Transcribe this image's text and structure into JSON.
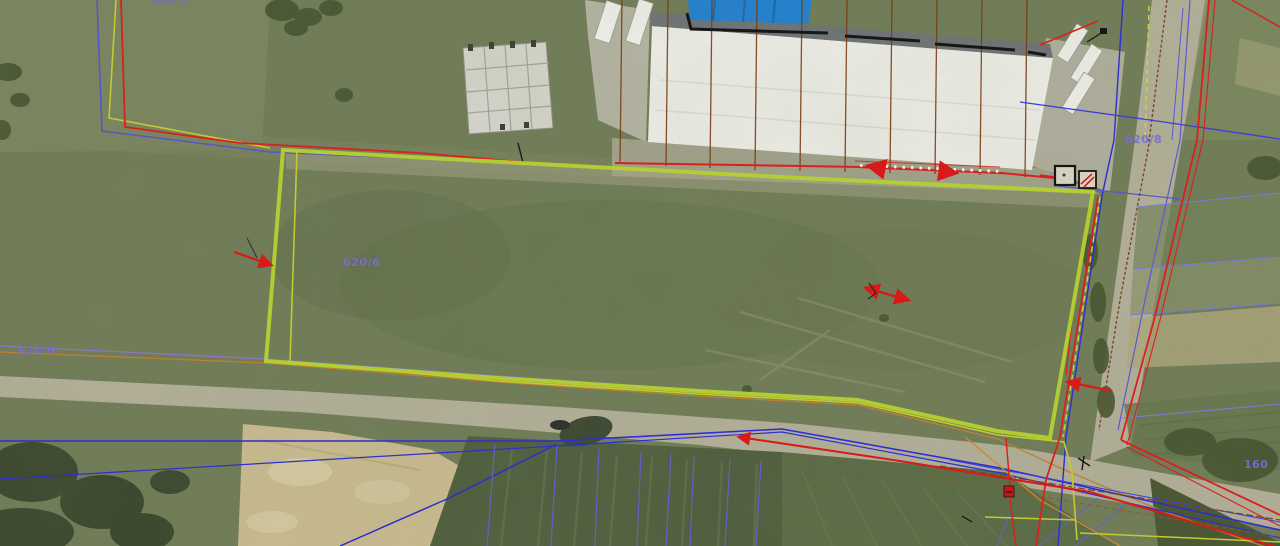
{
  "map": {
    "description": "Aerial orthophoto with cadastral vector overlay; lime-highlighted subject parcel",
    "parcel_labels": [
      {
        "id": "left-road",
        "text": "620/6"
      },
      {
        "id": "center-parcel",
        "text": "620/6"
      },
      {
        "id": "right-road",
        "text": "620/8"
      },
      {
        "id": "bottom-right-partial",
        "text": "160"
      },
      {
        "id": "top-partial",
        "text": "620/7"
      }
    ],
    "layer_colors": {
      "highlight_parcel": "#b8d52e",
      "survey_yellow": "#c6cf30",
      "cadastral_red": "#e01b1b",
      "utility_blue": "#2a2ad8",
      "parcel_purple": "#7b6fd8",
      "infrastructure_orange": "#c08030",
      "road_centerline_brown": "#7a4420"
    }
  }
}
